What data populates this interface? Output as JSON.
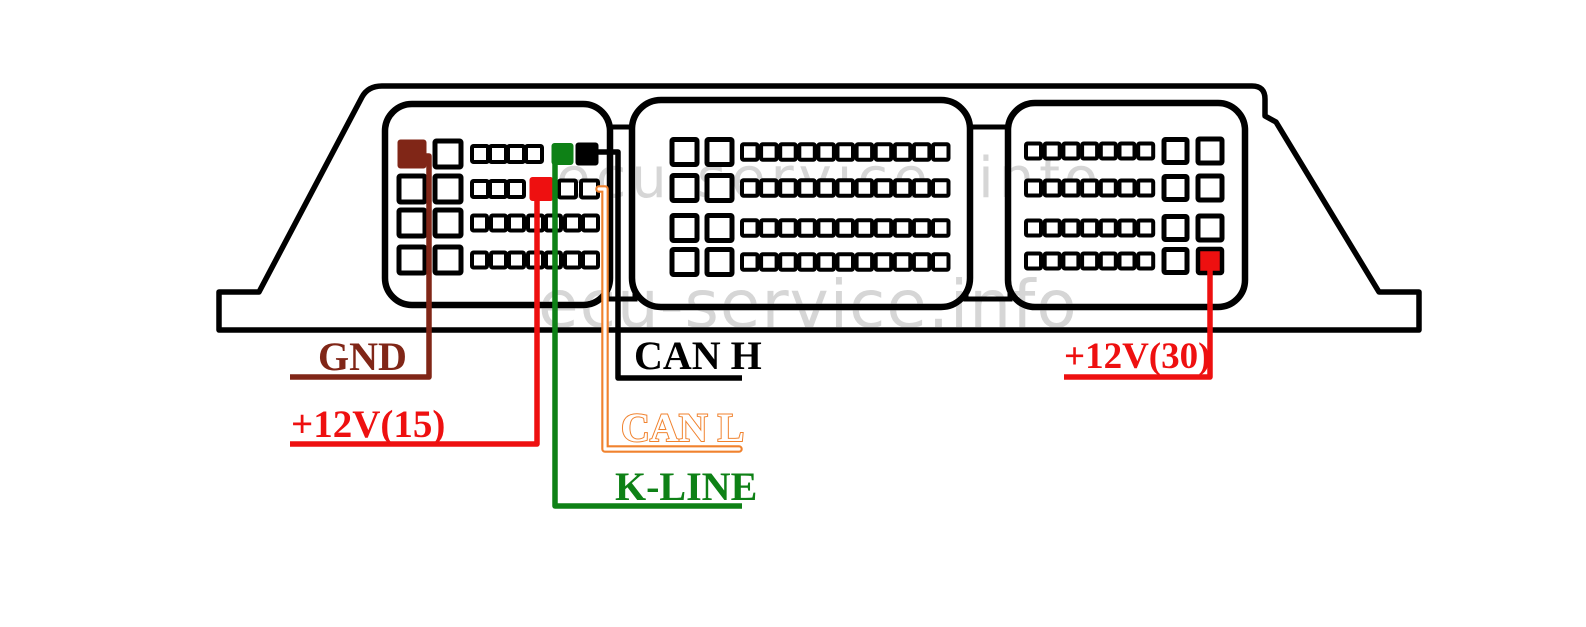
{
  "watermarks": {
    "top": "ecu-service. info",
    "bottom": "ecu-service.info"
  },
  "labels": {
    "gnd": "GND",
    "power15": "+12V(15)",
    "can_h": "CAN H",
    "can_l": "CAN L",
    "k_line": "K-LINE",
    "power30": "+12V(30)"
  },
  "colors": {
    "gnd": "#802617",
    "power": "#ee1010",
    "can_h": "#000000",
    "can_l": "#f0822e",
    "k_line": "#0e8116",
    "outline": "#000000",
    "watermark": "#d6d6d6",
    "background": "#ffffff"
  },
  "connectors": {
    "left": {
      "rows": [
        [
          "large:gnd",
          "large",
          "small",
          "small",
          "small",
          "small",
          "small:k_line",
          "small:can_h"
        ],
        [
          "large",
          "large",
          "small",
          "small",
          "small",
          "small:power15",
          "small",
          "small"
        ],
        [
          "large",
          "large",
          "small",
          "small",
          "small",
          "small",
          "small",
          "small",
          "small"
        ],
        [
          "large",
          "large",
          "small",
          "small",
          "small",
          "small",
          "small",
          "small",
          "small"
        ]
      ]
    },
    "middle": {
      "rows": [
        [
          "large",
          "large",
          "small",
          "small",
          "small",
          "small",
          "small",
          "small",
          "small",
          "small",
          "small",
          "small",
          "small"
        ],
        [
          "large",
          "large",
          "small",
          "small",
          "small",
          "small",
          "small",
          "small",
          "small",
          "small",
          "small",
          "small",
          "small"
        ],
        [
          "large",
          "large",
          "small",
          "small",
          "small",
          "small",
          "small",
          "small",
          "small",
          "small",
          "small",
          "small",
          "small"
        ],
        [
          "large",
          "large",
          "small",
          "small",
          "small",
          "small",
          "small",
          "small",
          "small",
          "small",
          "small",
          "small",
          "small"
        ]
      ]
    },
    "right": {
      "rows": [
        [
          "small",
          "small",
          "small",
          "small",
          "small",
          "small",
          "small",
          "large",
          "large"
        ],
        [
          "small",
          "small",
          "small",
          "small",
          "small",
          "small",
          "small",
          "large",
          "large"
        ],
        [
          "small",
          "small",
          "small",
          "small",
          "small",
          "small",
          "small",
          "large",
          "large"
        ],
        [
          "small",
          "small",
          "small",
          "small",
          "small",
          "small",
          "small",
          "large",
          "large:power30"
        ]
      ]
    }
  }
}
